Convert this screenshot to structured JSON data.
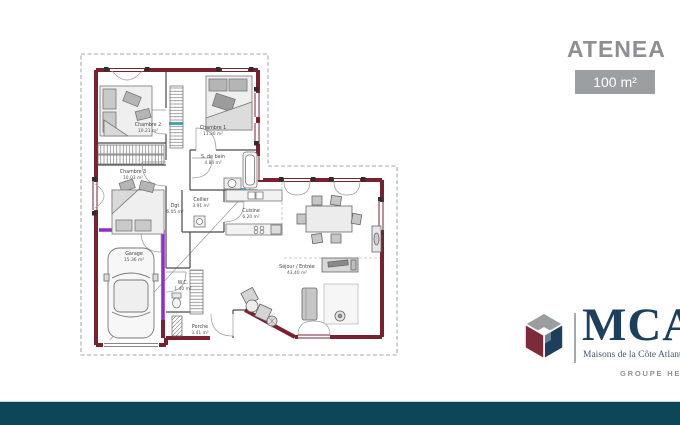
{
  "header": {
    "title": "ATENEA",
    "area": "100 m²"
  },
  "rooms": {
    "chambre2": {
      "name": "Chambre 2",
      "area": "10.21 m²"
    },
    "chambre1": {
      "name": "Chambre 1",
      "area": "11.30 m²"
    },
    "chambre3": {
      "name": "Chambre 3",
      "area": "10.03 m²"
    },
    "sdb": {
      "name": "S. de bain",
      "area": "4.84 m²"
    },
    "dgt": {
      "name": "Dgt",
      "area": "6.05 m²"
    },
    "cellier": {
      "name": "Cellier",
      "area": "3.91 m²"
    },
    "cuisine": {
      "name": "Cuisine",
      "area": "6.20 m²"
    },
    "sejour": {
      "name": "Séjour / Entrée",
      "area": "43.40 m²"
    },
    "garage": {
      "name": "Garage",
      "area": "15.36 m²"
    },
    "wc": {
      "name": "W.C.",
      "area": "1.40 m²"
    },
    "porche": {
      "name": "Porche",
      "area": "3.41 m²"
    }
  },
  "branding": {
    "logo": "MCA",
    "tagline": "Maisons de la Côte Atlantique",
    "group": "GROUPE HEXAOM"
  },
  "colors": {
    "wall": "#7a2130",
    "garage_wall": "#8c2fc8",
    "window_mark": "#39b7c4",
    "title_gray": "#8d8f92",
    "badge_gray": "#9b9fa2",
    "logo_navy": "#1d3f5e",
    "logo_maroon": "#7c2b3a",
    "logo_gray": "#9b9ea1",
    "footer_band": "#0d4659"
  }
}
